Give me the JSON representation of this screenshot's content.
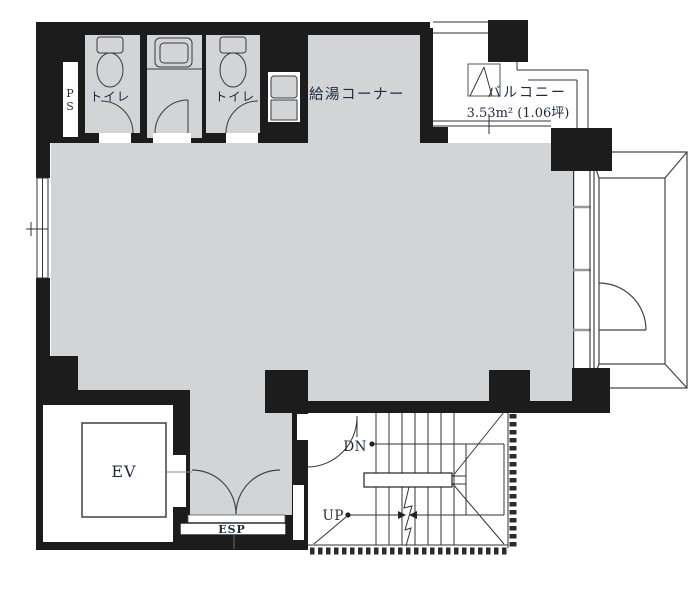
{
  "labels": {
    "ps_p": "P",
    "ps_s": "S",
    "toilet_left": "トイレ",
    "toilet_right": "トイレ",
    "kitchenette": "給湯コーナー",
    "balcony": "バルコニー",
    "balcony_area": "3.53m² (1.06坪)",
    "elevator": "EV",
    "esp": "ESP",
    "stairs_down": "DN",
    "stairs_up": "UP"
  },
  "colors": {
    "wall": "#1c1c1c",
    "floor": "#d3d4d6",
    "background": "#ffffff",
    "line": "#3a3a3a",
    "text": "#1f2940"
  }
}
